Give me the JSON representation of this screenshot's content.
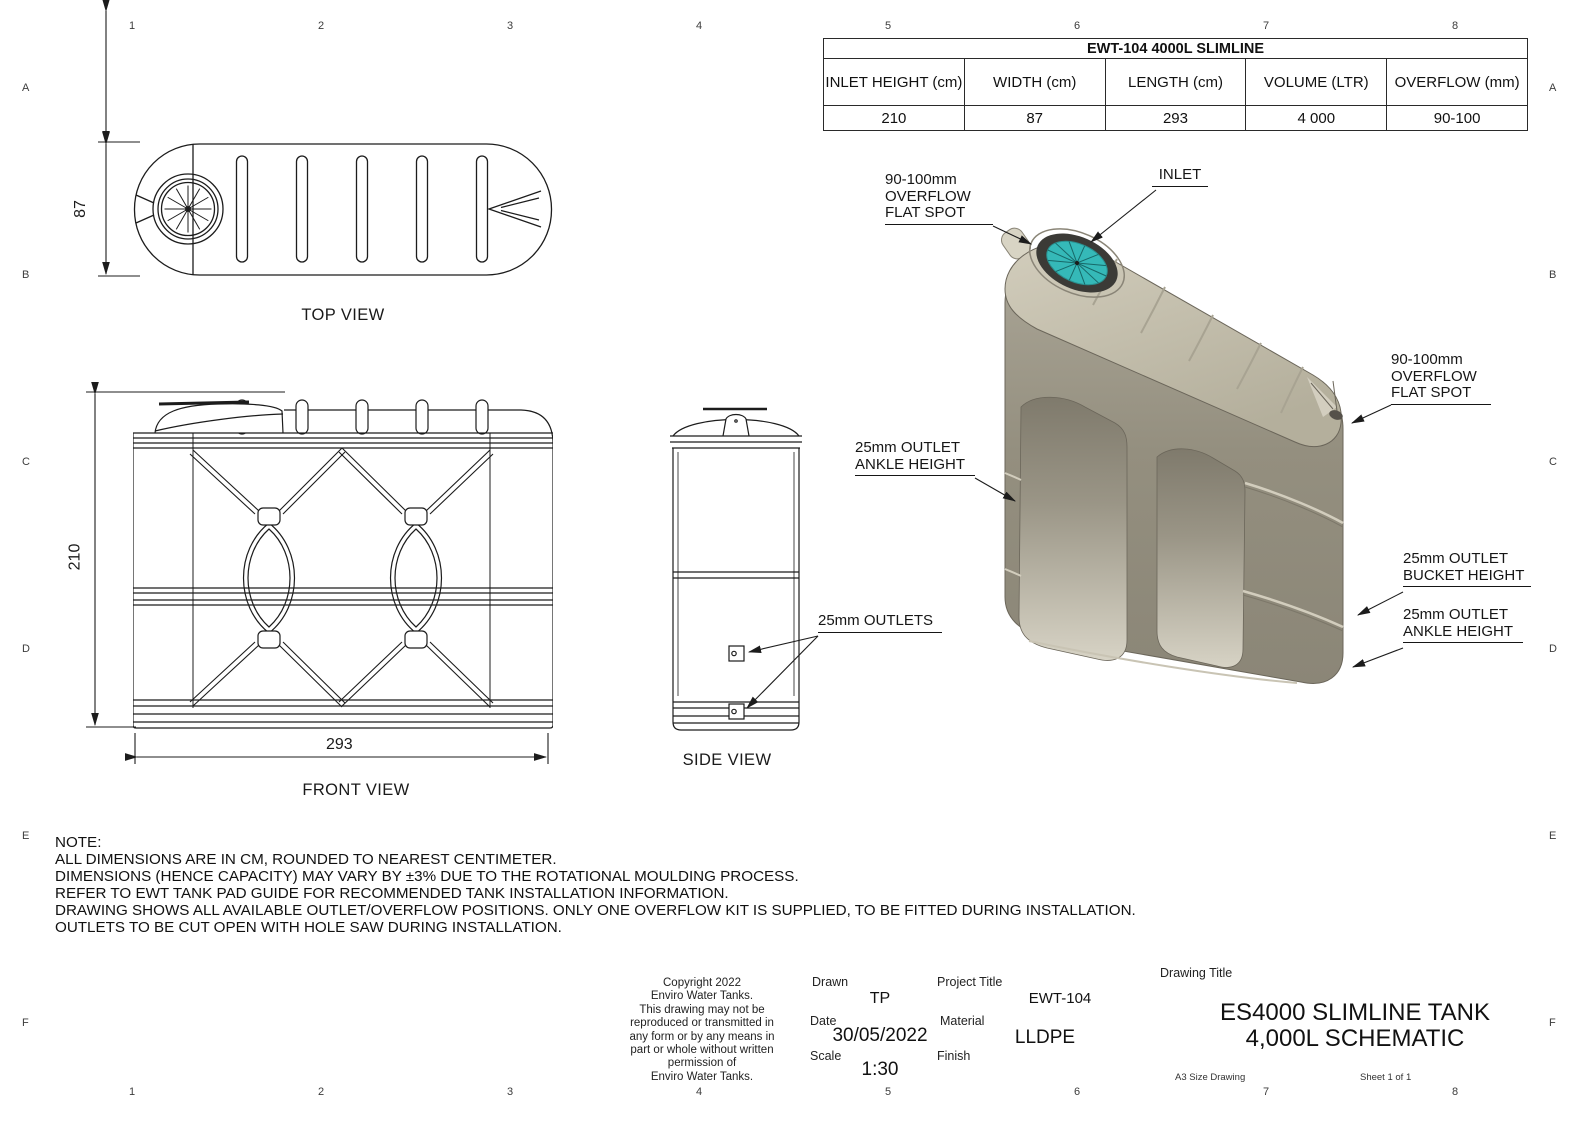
{
  "grid": {
    "columns": [
      "1",
      "2",
      "3",
      "4",
      "5",
      "6",
      "7",
      "8"
    ],
    "rows": [
      "A",
      "B",
      "C",
      "D",
      "E",
      "F"
    ]
  },
  "spec_table": {
    "title": "EWT-104 4000L SLIMLINE",
    "headers": [
      "INLET HEIGHT (cm)",
      "WIDTH (cm)",
      "LENGTH (cm)",
      "VOLUME (LTR)",
      "OVERFLOW (mm)"
    ],
    "values": [
      "210",
      "87",
      "293",
      "4 000",
      "90-100"
    ]
  },
  "views": {
    "top": {
      "label": "TOP VIEW"
    },
    "front": {
      "label": "FRONT VIEW"
    },
    "side": {
      "label": "SIDE VIEW"
    }
  },
  "dimensions": {
    "width": "87",
    "height": "210",
    "length": "293"
  },
  "callouts": [
    {
      "id": "overflow-left",
      "lines": [
        "90-100mm",
        "OVERFLOW",
        "FLAT SPOT"
      ]
    },
    {
      "id": "inlet",
      "lines": [
        "INLET"
      ]
    },
    {
      "id": "overflow-right",
      "lines": [
        "90-100mm",
        "OVERFLOW",
        "FLAT SPOT"
      ]
    },
    {
      "id": "outlet-ankle-left",
      "lines": [
        "25mm OUTLET",
        "ANKLE HEIGHT"
      ]
    },
    {
      "id": "outlet-bucket-right",
      "lines": [
        "25mm OUTLET",
        "BUCKET HEIGHT"
      ]
    },
    {
      "id": "outlet-ankle-right",
      "lines": [
        "25mm OUTLET",
        "ANKLE HEIGHT"
      ]
    },
    {
      "id": "outlets-side",
      "lines": [
        "25mm OUTLETS"
      ]
    }
  ],
  "notes": {
    "title": "NOTE:",
    "lines": [
      "ALL DIMENSIONS ARE IN CM, ROUNDED TO NEAREST CENTIMETER.",
      "DIMENSIONS (HENCE CAPACITY) MAY VARY BY ±3% DUE TO THE ROTATIONAL MOULDING PROCESS.",
      "REFER TO EWT TANK PAD GUIDE FOR RECOMMENDED TANK INSTALLATION INFORMATION.",
      "DRAWING SHOWS ALL AVAILABLE OUTLET/OVERFLOW POSITIONS. ONLY ONE OVERFLOW KIT IS SUPPLIED, TO BE FITTED DURING INSTALLATION.",
      "OUTLETS TO BE CUT OPEN WITH HOLE SAW DURING INSTALLATION."
    ]
  },
  "title_block": {
    "copyright_lines": [
      "Copyright 2022",
      "Enviro Water Tanks.",
      "This drawing may not be",
      "reproduced or transmitted in",
      "any form or by any means in",
      "part or whole without written",
      "permission of",
      "Enviro Water Tanks."
    ],
    "drawn_label": "Drawn",
    "drawn_value": "TP",
    "date_label": "Date",
    "date_value": "30/05/2022",
    "scale_label": "Scale",
    "scale_value": "1:30",
    "project_title_label": "Project Title",
    "project_title_value": "EWT-104",
    "material_label": "Material",
    "material_value": "LLDPE",
    "finish_label": "Finish",
    "drawing_title_label": "Drawing Title",
    "drawing_title_line1": "ES4000 SLIMLINE TANK",
    "drawing_title_line2": "4,000L SCHEMATIC",
    "sheet_size": "A3 Size Drawing",
    "sheet_number": "Sheet 1 of 1"
  },
  "colors": {
    "line": "#1c1c1c",
    "tank_top": "#c9c4b2",
    "tank_front": "#9d9888",
    "tank_shadow": "#8b8677",
    "recess_light": "#d7d3c5",
    "inlet_teal": "#35b9b8",
    "inlet_ring": "#3b3a36"
  }
}
